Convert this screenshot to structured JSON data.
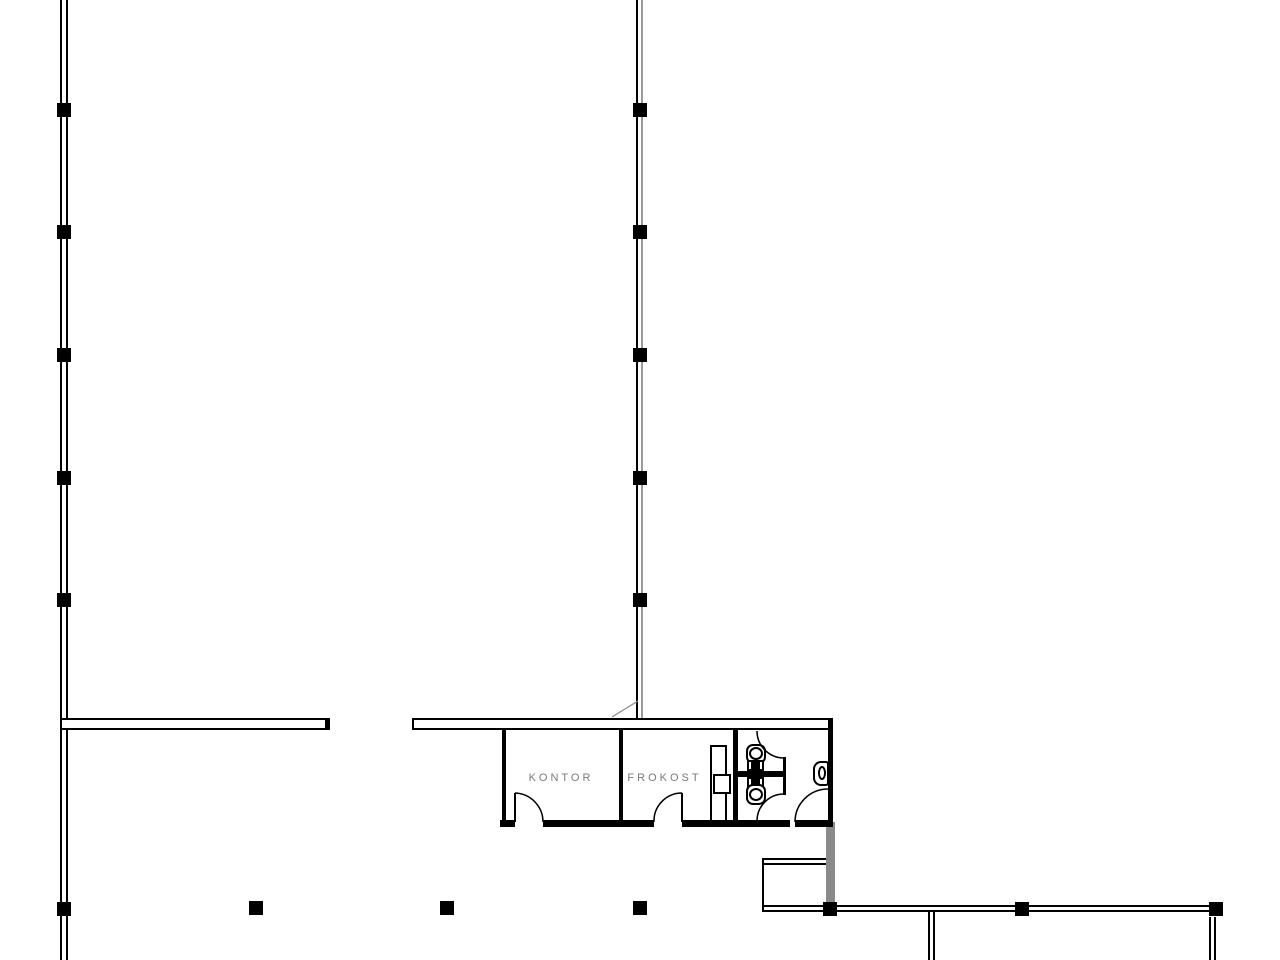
{
  "plan": {
    "labels": {
      "kontor": "KONTOR",
      "frokost": "FROKOST"
    }
  },
  "columns": {
    "size": 14,
    "positions": [
      {
        "x": 64,
        "y": 110
      },
      {
        "x": 64,
        "y": 232
      },
      {
        "x": 64,
        "y": 355
      },
      {
        "x": 64,
        "y": 478
      },
      {
        "x": 64,
        "y": 600
      },
      {
        "x": 64,
        "y": 909
      },
      {
        "x": 640,
        "y": 110
      },
      {
        "x": 640,
        "y": 232
      },
      {
        "x": 640,
        "y": 355
      },
      {
        "x": 640,
        "y": 478
      },
      {
        "x": 640,
        "y": 600
      },
      {
        "x": 256,
        "y": 908
      },
      {
        "x": 447,
        "y": 908
      },
      {
        "x": 640,
        "y": 908
      },
      {
        "x": 830,
        "y": 909
      },
      {
        "x": 1022,
        "y": 909
      },
      {
        "x": 1216,
        "y": 909
      }
    ]
  },
  "colors": {
    "line": "#000000",
    "secondary_line": "#9a9a9a",
    "wall_gray": "#8a8a8a",
    "label_text": "#7a7a7a",
    "background": "#ffffff"
  }
}
